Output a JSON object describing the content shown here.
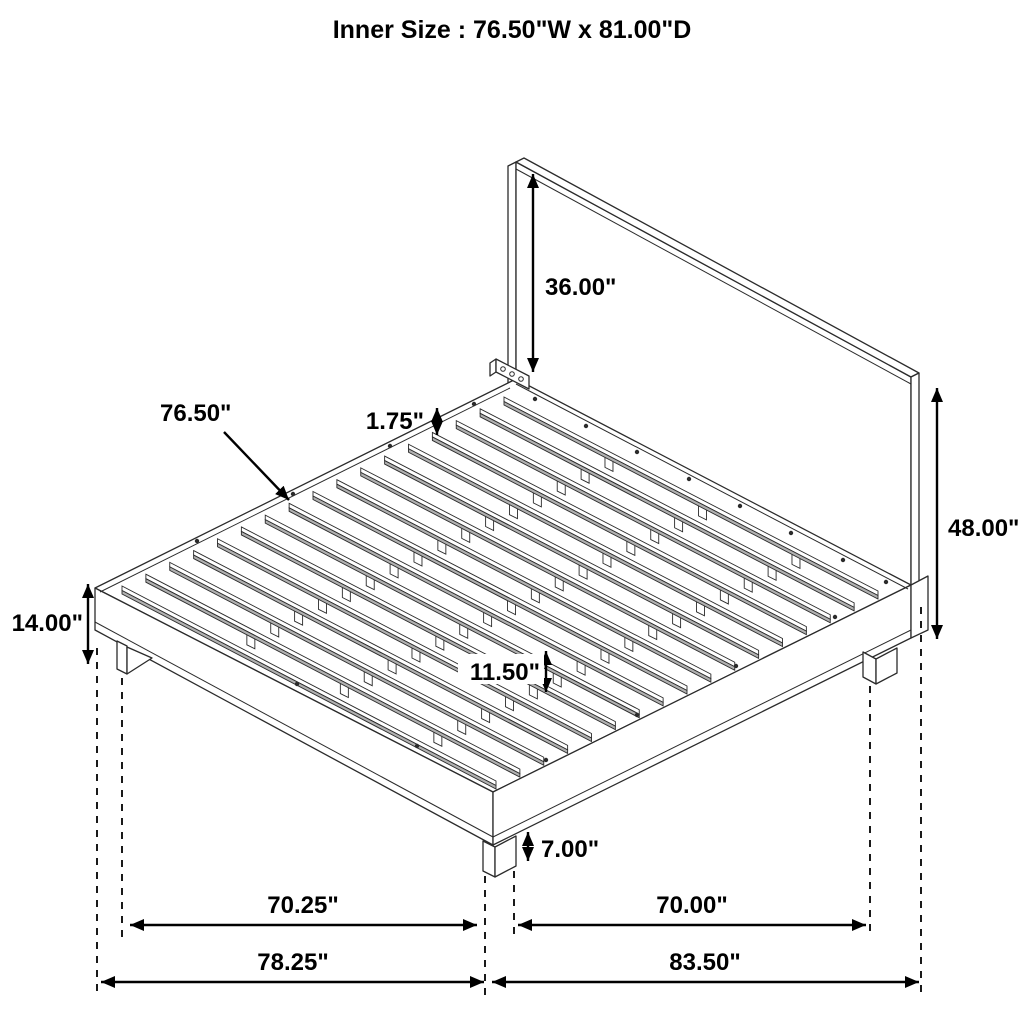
{
  "title": "Inner Size : 76.50\"W x 81.00\"D",
  "diagram": {
    "kind": "isometric dimension drawing of platform bed frame with headboard and slats",
    "slat_count": 17,
    "support_tab_fractions": [
      0.27,
      0.52,
      0.77
    ],
    "colors": {
      "line": "#2b2b2b",
      "slat_shade": "#b0b0b0",
      "dimension": "#000000",
      "background": "#ffffff"
    }
  },
  "dimensions": {
    "headboard_panel_height": "36.00\"",
    "headboard_total_height": "48.00\"",
    "slat_length": "76.50\"",
    "slat_thickness": "1.75\"",
    "platform_height": "14.00\"",
    "clearance_under_slats": "11.50\"",
    "leg_height": "7.00\"",
    "front_leg_spacing": "70.25\"",
    "side_leg_spacing": "70.00\"",
    "overall_width": "78.25\"",
    "overall_depth": "83.50\""
  }
}
